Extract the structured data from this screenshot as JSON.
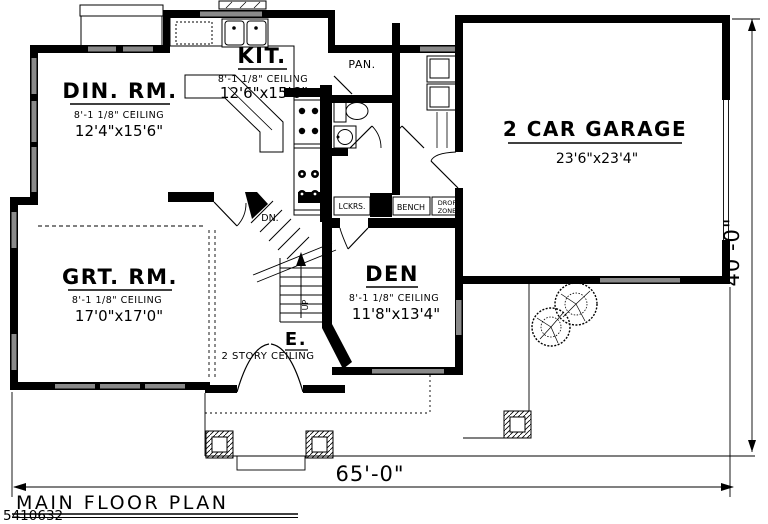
{
  "meta": {
    "title": "MAIN FLOOR PLAN",
    "watermark": "5410632"
  },
  "dimensions": {
    "overall_width": "65'-0\"",
    "overall_depth": "40'-0\""
  },
  "rooms": {
    "dining": {
      "name": "DIN. RM.",
      "ceiling": "8'-1 1/8\" CEILING",
      "size": "12'4\"x15'6\""
    },
    "kitchen": {
      "name": "KIT.",
      "ceiling": "8'-1 1/8\" CEILING",
      "size": "12'6\"x15'6\""
    },
    "pantry": {
      "name": "PAN."
    },
    "garage": {
      "name": "2 CAR GARAGE",
      "size": "23'6\"x23'4\""
    },
    "great_room": {
      "name": "GRT. RM.",
      "ceiling": "8'-1 1/8\" CEILING",
      "size": "17'0\"x17'0\""
    },
    "den": {
      "name": "DEN",
      "ceiling": "8'-1 1/8\" CEILING",
      "size": "11'8\"x13'4\""
    },
    "entry": {
      "name": "E.",
      "ceiling": "2 STORY CEILING"
    },
    "stairs": {
      "down_label": "DN.",
      "up_label": "UP"
    },
    "mudroom": {
      "lockers": "LCKRS.",
      "bench": "BENCH",
      "drop_zone_line1": "DROP",
      "drop_zone_line2": "ZONE"
    }
  },
  "colors": {
    "wall": "#000000",
    "window": "#8a8a8a",
    "background": "#ffffff"
  }
}
